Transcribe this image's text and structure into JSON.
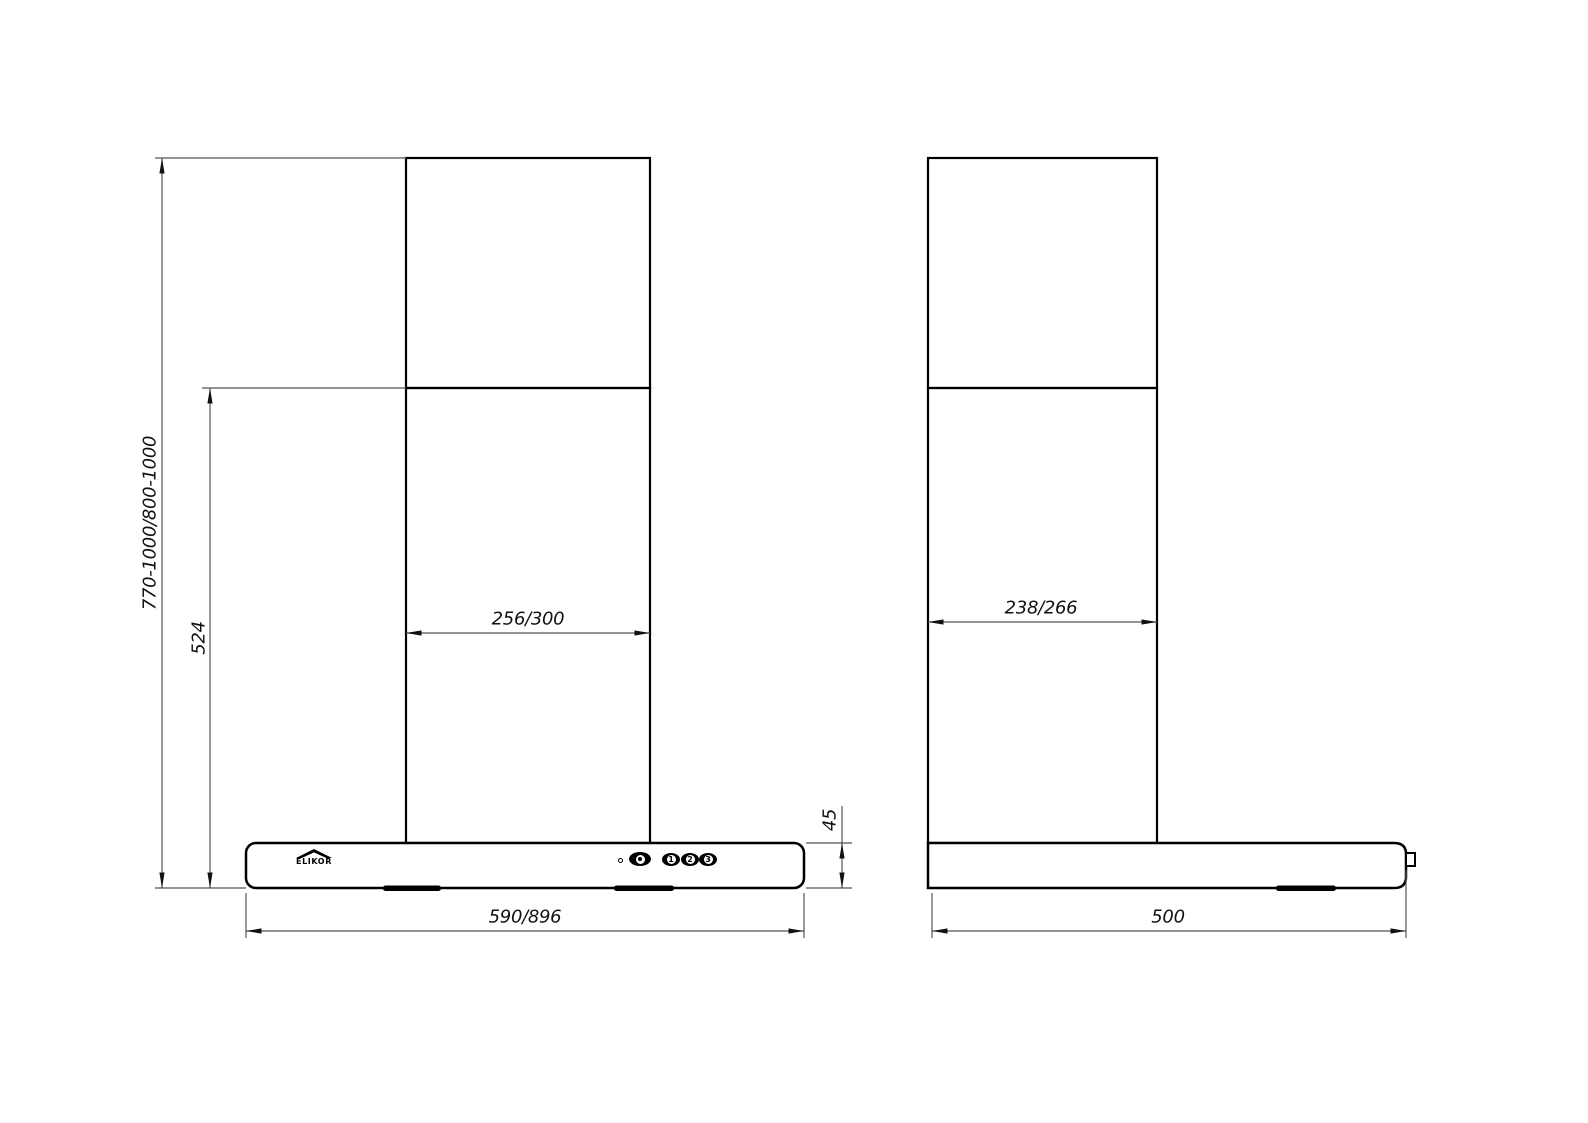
{
  "drawing": {
    "brand_logo": {
      "name": "ELIKOR",
      "icon": "roof-icon"
    },
    "front_view": {
      "dimensions": {
        "overall_height": "770-1000/800-1000",
        "height_from_joint": "524",
        "duct_width": "256/300",
        "body_width": "590/896",
        "body_height": "45"
      }
    },
    "side_view": {
      "dimensions": {
        "duct_depth": "238/266",
        "body_depth": "500"
      }
    },
    "controls": {
      "indicator": "led-indicator",
      "light_button_icon": "bulb-icon",
      "speed_buttons": [
        "1",
        "2",
        "3"
      ]
    },
    "colors": {
      "line": "#000000",
      "dim_line": "#555555",
      "background": "#ffffff"
    }
  }
}
